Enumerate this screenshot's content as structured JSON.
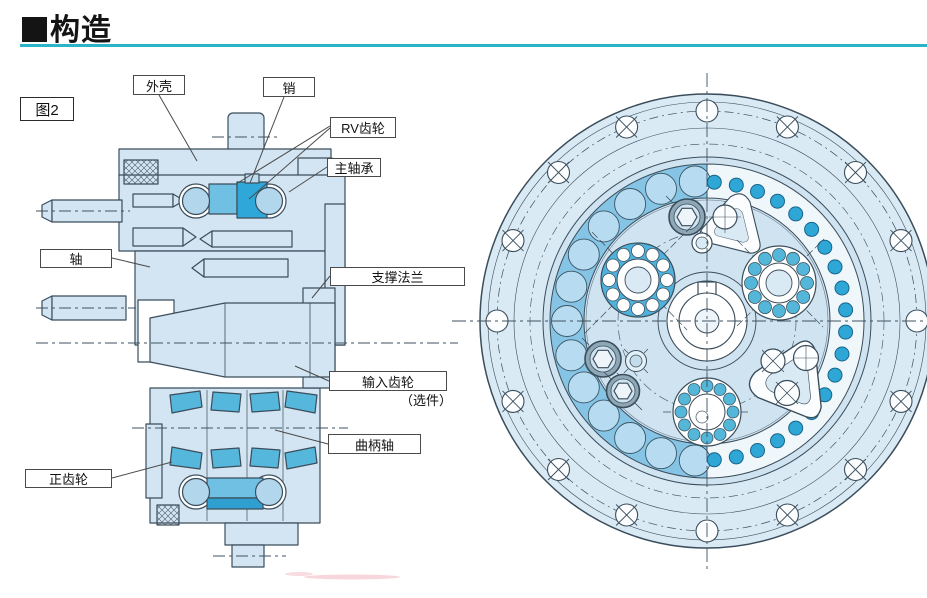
{
  "page": {
    "title": "构造",
    "title_bullet": "■",
    "figure_label": "图2"
  },
  "callouts": {
    "housing": "外壳",
    "pin": "销",
    "rv_gear": "RV齿轮",
    "main_bearing": "主轴承",
    "shaft": "轴",
    "support_flange": "支撑法兰",
    "input_gear": "输入齿轮",
    "input_gear_note": "（选件）",
    "crankshaft": "曲柄轴",
    "spur_gear": "正齿轮"
  },
  "colors": {
    "rule_teal": "#2bb3c7",
    "body_light_blue": "#d3e5f2",
    "gear_blue": "#2fa8d9",
    "pin_blue": "#2ea6d6",
    "outline": "#3b4d5b"
  }
}
